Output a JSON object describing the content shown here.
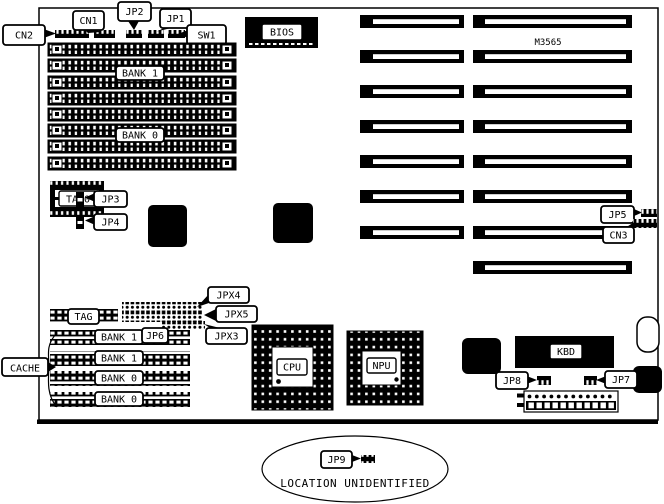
{
  "figure": {
    "type": "motherboard jumper and connector location diagram",
    "colors": {
      "ink": "#000000",
      "paper": "#ffffff"
    }
  },
  "labels": {
    "cn2": "CN2",
    "cn1": "CN1",
    "jp2": "JP2",
    "jp1": "JP1",
    "sw1": "SW1",
    "bios": "BIOS",
    "chipset": "M3565",
    "tag0": "TAG0",
    "jp3": "JP3",
    "jp4": "JP4",
    "jp5": "JP5",
    "cn3": "CN3",
    "jpx4": "JPX4",
    "jpx5": "JPX5",
    "jpx3": "JPX3",
    "tag": "TAG",
    "jp6": "JP6",
    "cache": "CACHE",
    "cpu": "CPU",
    "npu": "NPU",
    "kbd": "KBD",
    "jp8": "JP8",
    "jp7": "JP7",
    "jp9": "JP9",
    "jp9_note": "LOCATION UNIDENTIFIED"
  },
  "memory": {
    "bank1": "BANK 1",
    "bank0": "BANK 0",
    "simm_socket_count": 8
  },
  "cache_rows": [
    "BANK 1",
    "BANK 1",
    "BANK 0",
    "BANK 0"
  ],
  "expansion_slots": {
    "two_segment_slot_count": 7,
    "single_segment_slot_count": 1
  }
}
